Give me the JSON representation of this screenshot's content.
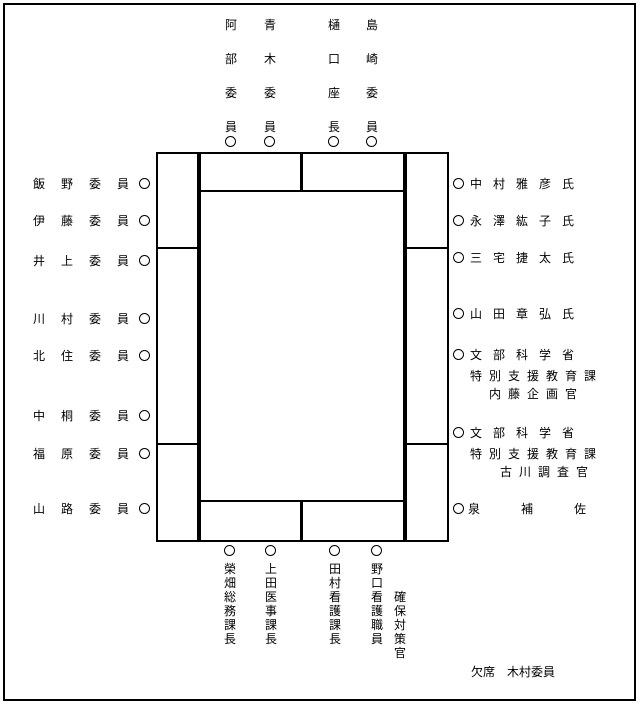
{
  "page": {
    "ink_color": "#000000",
    "paper_color": "#ffffff",
    "seat_marker_symbol": "○"
  },
  "seating_chart": {
    "top_seats": [
      "阿部委員",
      "青木委員",
      "樋口座長",
      "島崎委員"
    ],
    "left_seats": [
      "飯野委員",
      "伊藤委員",
      "井上委員",
      "川村委員",
      "北住委員",
      "中桐委員",
      "福原委員",
      "山路委員"
    ],
    "right_seats": [
      {
        "line1": "中村雅彦氏"
      },
      {
        "line1": "永澤紘子氏"
      },
      {
        "line1": "三宅捷太氏"
      },
      {
        "line1": "山田章弘氏"
      },
      {
        "line1": "文部科学省",
        "line2": "特別支援教育課",
        "line3": "内藤企画官"
      },
      {
        "line1": "文部科学省",
        "line2": "特別支援教育課",
        "line3": "古川調査官"
      },
      {
        "line1": "泉補佐"
      }
    ],
    "bottom_seats": [
      {
        "col1": "榮畑総務課長"
      },
      {
        "col1": "上田医事課長"
      },
      {
        "col1": "田村看護課長"
      },
      {
        "col1": "野口看護職員",
        "col2": "確保対策官"
      }
    ],
    "absent_note": "欠席　木村委員"
  }
}
